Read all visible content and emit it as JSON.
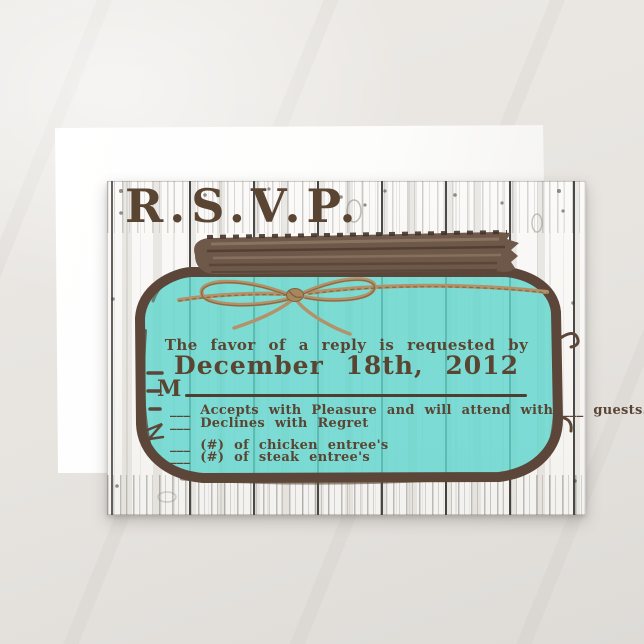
{
  "scene": {
    "description": "product photo of rustic mason jar wedding RSVP card over white envelope",
    "background_color": "#e7e4e0",
    "envelope_color": "#ffffff"
  },
  "card": {
    "title": "R.S.V.P.",
    "reply_request": "The favor of a reply is requested by",
    "reply_date": "December 18th, 2012",
    "name_prefix": "M",
    "options": [
      {
        "label": "___  Accepts with Pleasure and will attend with ___ guests."
      },
      {
        "label": "___  Declines with Regret"
      },
      {
        "label": "___  (#) of chicken entree's"
      },
      {
        "label": "___  (#) of steak entree's"
      }
    ],
    "colors": {
      "title_brown": "#6a5545",
      "text_brown": "#5a4533",
      "jar_teal": "#8edcd8",
      "jar_outline": "#5b4639",
      "lid_brown": "#6e5849",
      "twine_tan": "#b3926a",
      "wood_white": "#f8f7f5",
      "plank_gap": "#2e2b28"
    },
    "illustration": {
      "name": "mason-jar-with-twine-bow",
      "elements": [
        "wood-plank-background",
        "jar-lid",
        "jar-body",
        "twine-bow"
      ]
    }
  }
}
